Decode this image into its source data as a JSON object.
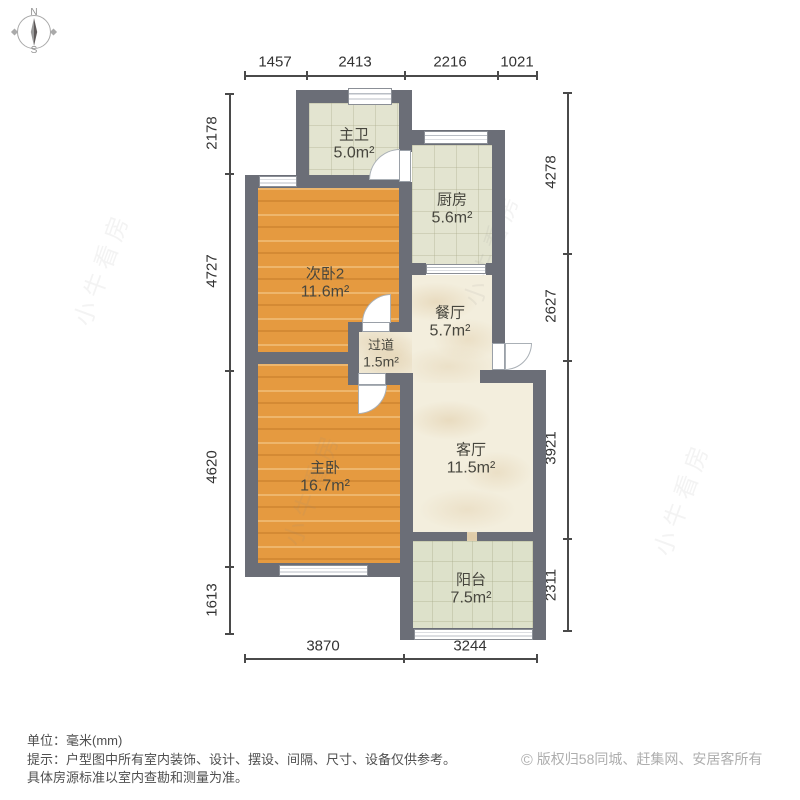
{
  "compass": {
    "north": "N",
    "south": "S"
  },
  "dimensions": {
    "unit": "mm",
    "top": [
      "1457",
      "2413",
      "2216",
      "1021"
    ],
    "left": [
      "2178",
      "4727",
      "4620",
      "1613"
    ],
    "right": [
      "4278",
      "2627",
      "3921",
      "2311"
    ],
    "bottom": [
      "3870",
      "3244"
    ]
  },
  "rooms": [
    {
      "id": "master-bath",
      "name": "主卫",
      "area": "5.0m²"
    },
    {
      "id": "kitchen",
      "name": "厨房",
      "area": "5.6m²"
    },
    {
      "id": "bedroom-2",
      "name": "次卧2",
      "area": "11.6m²"
    },
    {
      "id": "dining-room",
      "name": "餐厅",
      "area": "5.7m²"
    },
    {
      "id": "hallway",
      "name": "过道",
      "area": "1.5m²"
    },
    {
      "id": "master-bedroom",
      "name": "主卧",
      "area": "16.7m²"
    },
    {
      "id": "living-room",
      "name": "客厅",
      "area": "11.5m²"
    },
    {
      "id": "balcony",
      "name": "阳台",
      "area": "7.5m²"
    }
  ],
  "watermark": "小牛看房",
  "footer": {
    "unit_line": "单位：毫米(mm)",
    "tip_line1": "提示：户型图中所有室内装饰、设计、摆设、间隔、尺寸、设备仅供参考。",
    "tip_line2": "具体房源标准以室内查勘和测量为准。",
    "copyright_symbol": "©",
    "copyright": "版权归58同城、赶集网、安居客所有"
  },
  "colors": {
    "wall": "#6b6e77",
    "wood_floor": "#e59a40",
    "tile_floor": "#e3e4d0",
    "balcony_tile": "#dde1ca",
    "marble_floor": "#f3eedd",
    "dimension_text": "#333333",
    "footer_text": "#4f4f4f",
    "copyright_text": "#aeaeae"
  }
}
